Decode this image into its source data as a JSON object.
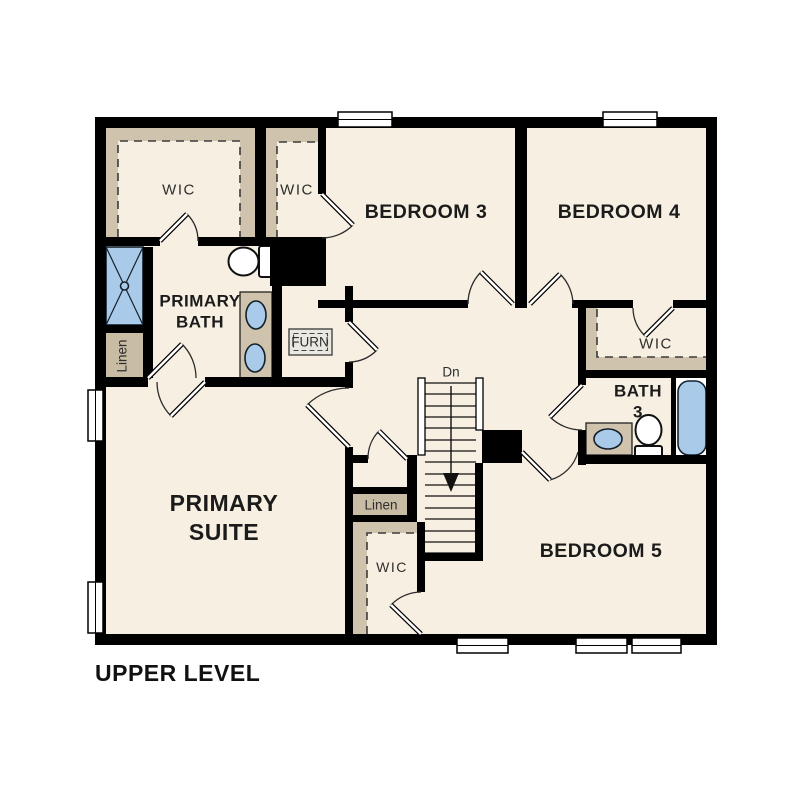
{
  "title": "UPPER LEVEL",
  "colors": {
    "background": "#ffffff",
    "floor": "#f7f0e2",
    "wall": "#000000",
    "closet_shelf": "#cfc3ad",
    "linen": "#c8bca4",
    "counter": "#cfc3ad",
    "fixture_blue": "#a9cbe9",
    "furnace_fill": "#e9e9e1",
    "text_dark": "#1b1b1b"
  },
  "labels": {
    "primary_wic": "WIC",
    "bedroom3_wic": "WIC",
    "bedroom3": "BEDROOM 3",
    "bedroom4": "BEDROOM 4",
    "bedroom4_wic": "WIC",
    "primary_bath_line1": "PRIMARY",
    "primary_bath_line2": "BATH",
    "primary_linen": "Linen",
    "furnace": "FURN",
    "stairs_down": "Dn",
    "bath3_line1": "BATH",
    "bath3_line2": "3",
    "primary_suite_line1": "PRIMARY",
    "primary_suite_line2": "SUITE",
    "hall_linen": "Linen",
    "bedroom5": "BEDROOM 5",
    "bedroom5_wic": "WIC"
  }
}
